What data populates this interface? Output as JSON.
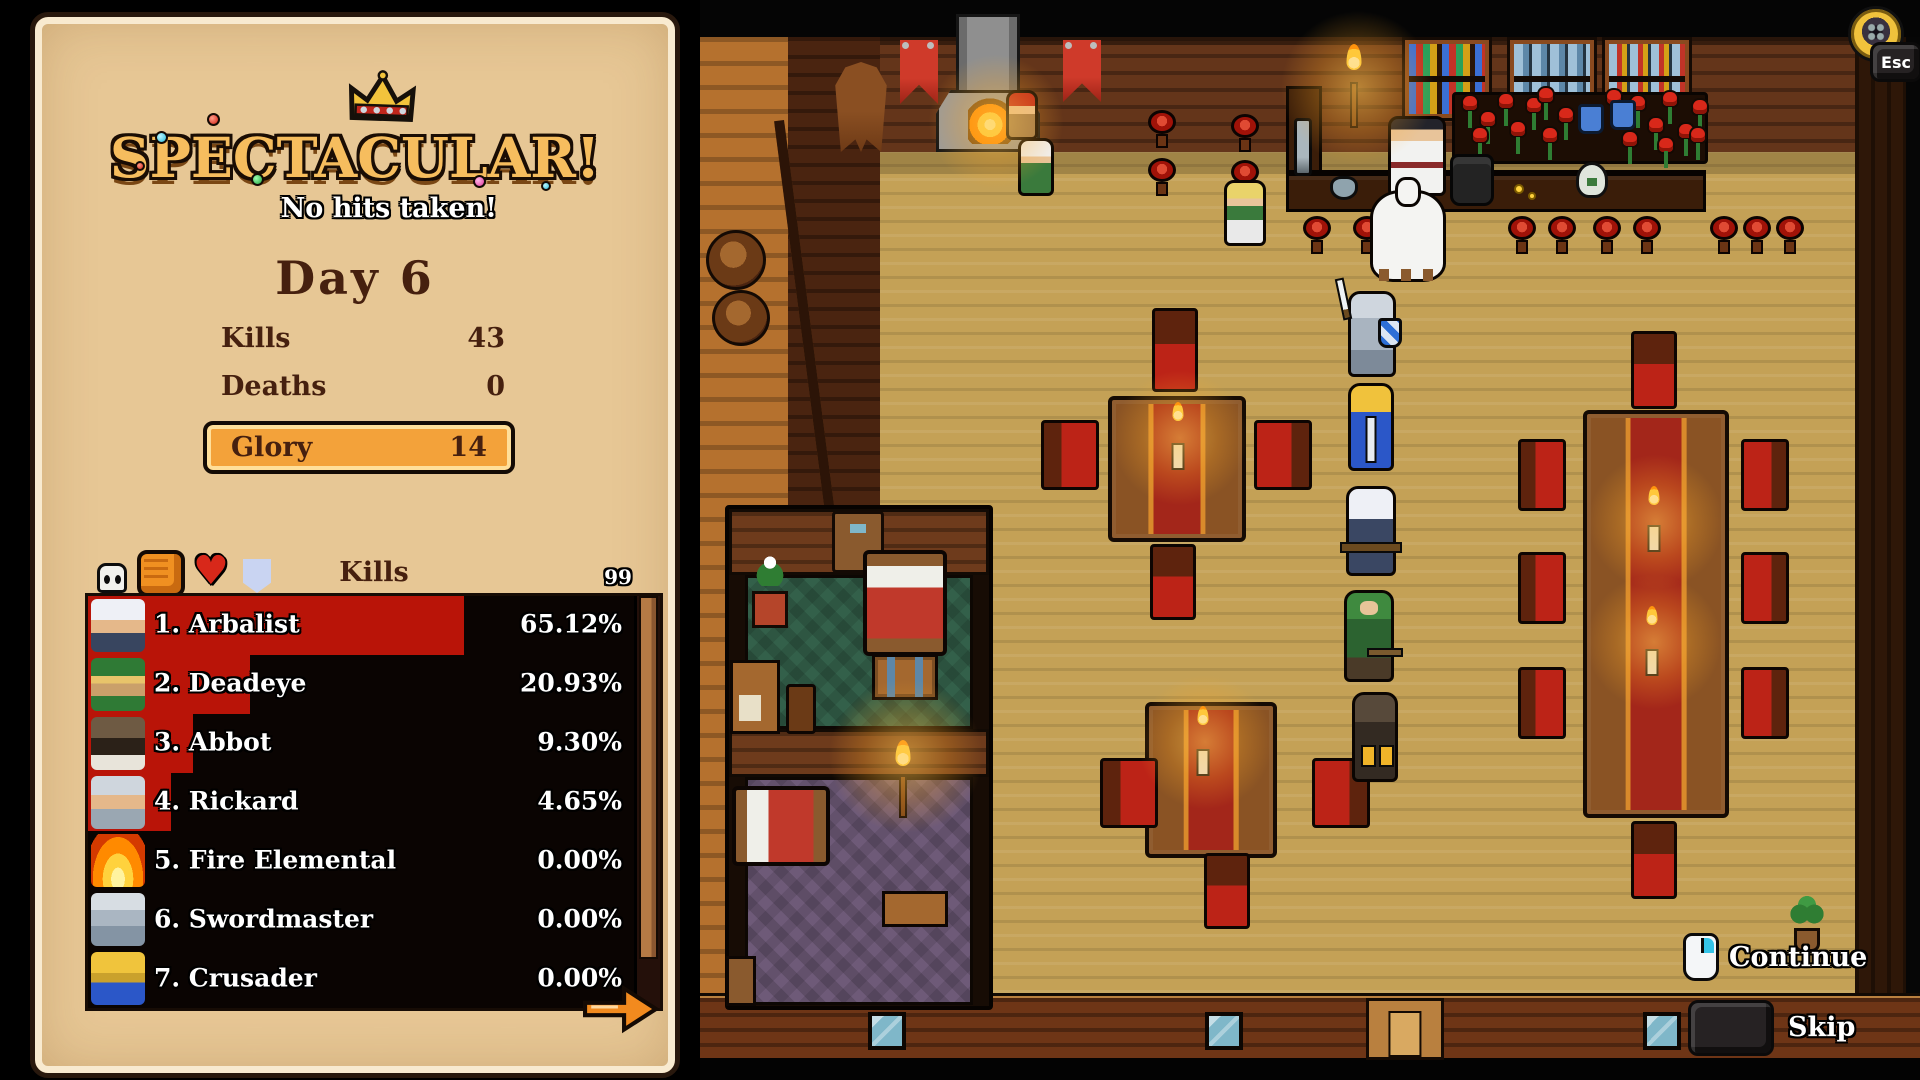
{
  "panel": {
    "logo": "SPECTACULAR!",
    "subtitle": "No hits taken!",
    "day": "Day 6",
    "stats": [
      {
        "label": "Kills",
        "value": "43"
      },
      {
        "label": "Deaths",
        "value": "0"
      }
    ],
    "glory_label": "Glory",
    "glory_value": "14",
    "board": {
      "filter_icons": [
        "skull-icon",
        "fist-icon",
        "heart-icon",
        "shield-icon"
      ],
      "metric": "Kills",
      "max": "99",
      "rows": [
        {
          "rank": "1.",
          "name": "Arbalist",
          "pct": "65.12%",
          "p": 65.12,
          "avatar": "arbalist"
        },
        {
          "rank": "2.",
          "name": "Deadeye",
          "pct": "20.93%",
          "p": 20.93,
          "avatar": "deadeye"
        },
        {
          "rank": "3.",
          "name": "Abbot",
          "pct": "9.30%",
          "p": 9.3,
          "avatar": "abbot"
        },
        {
          "rank": "4.",
          "name": "Rickard",
          "pct": "4.65%",
          "p": 4.65,
          "avatar": "rickard"
        },
        {
          "rank": "5.",
          "name": "Fire Elemental",
          "pct": "0.00%",
          "p": 0,
          "avatar": "fire-elemental"
        },
        {
          "rank": "6.",
          "name": "Swordmaster",
          "pct": "0.00%",
          "p": 0,
          "avatar": "swordmaster"
        },
        {
          "rank": "7.",
          "name": "Crusader",
          "pct": "0.00%",
          "p": 0,
          "avatar": "crusader"
        }
      ]
    }
  },
  "scene": {
    "continue_label": "Continue",
    "skip_label": "Skip",
    "esc_label": "Esc"
  },
  "icons": {
    "crown": "crown-icon",
    "next_page": "arrow-right-icon",
    "mouse": "mouse-icon",
    "skip_key": "keyboard-key-icon",
    "menu_coin": "esc-coin-icon"
  },
  "colors": {
    "parchment": "#e7c795",
    "accent_orange": "#f3a23a",
    "bar_red": "#b91408",
    "board_bg": "#0a0402",
    "text_brown": "#46200f"
  }
}
